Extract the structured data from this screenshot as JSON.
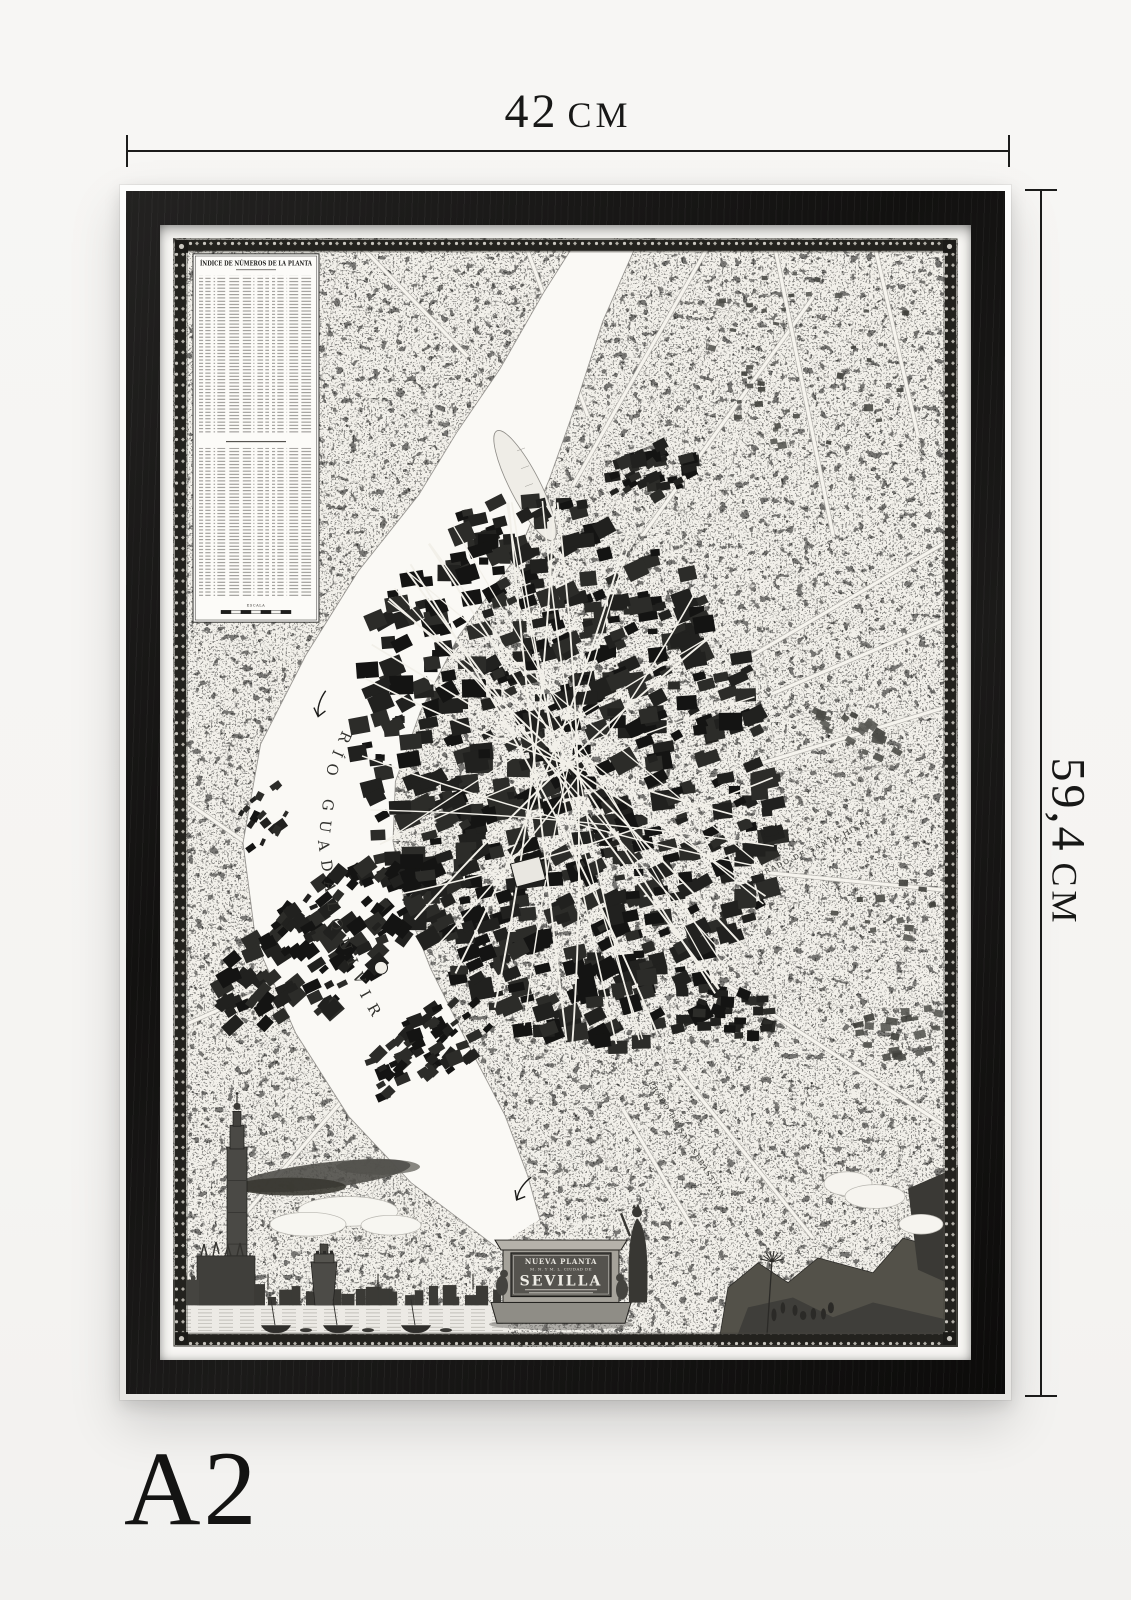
{
  "dimensions": {
    "width": {
      "value": "42",
      "unit": "CM"
    },
    "height": {
      "value": "59,4",
      "unit": "CM"
    },
    "size_label": "A2"
  },
  "poster": {
    "frame_color": "#141312",
    "mat_color": "#f8f7f4",
    "paper_color": "#f2f0ea"
  },
  "map": {
    "index_table": {
      "title": "ÍNDICE DE NÚMEROS DE LA PLANTA",
      "scale_label": "ESCALA"
    },
    "river_label": "RÍO GUADALQUIVIR",
    "area_labels": {
      "santa_justa": "PRADO DE SANTA JUSTA",
      "san_sebastian": "PRADO DE SAN SEBASTIÁN"
    },
    "cartouche": {
      "line1": "NUEVA PLANTA",
      "line2": "M. N. Y M. L. CIUDAD DE",
      "title": "SEVILLA"
    }
  }
}
